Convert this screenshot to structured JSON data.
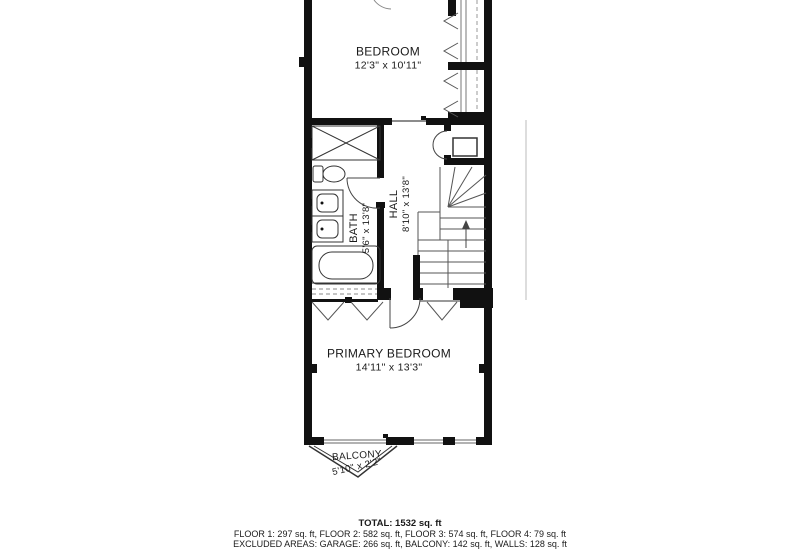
{
  "rooms": {
    "bedroom": {
      "name": "BEDROOM",
      "dims": "12'3\" x 10'11\""
    },
    "bath": {
      "name": "BATH",
      "dims": "5'6\" x 13'8\""
    },
    "hall": {
      "name": "HALL",
      "dims": "8'10\" x 13'8\""
    },
    "primary_bedroom": {
      "name": "PRIMARY BEDROOM",
      "dims": "14'11\" x 13'3\""
    },
    "balcony": {
      "name": "BALCONY",
      "dims": "5'10\" x 2'2\""
    }
  },
  "summary": {
    "total": "TOTAL: 1532 sq. ft",
    "floors": "FLOOR 1: 297 sq. ft, FLOOR 2: 582 sq. ft, FLOOR 3: 574 sq. ft, FLOOR 4: 79 sq. ft",
    "excluded": "EXCLUDED AREAS: GARAGE: 266 sq. ft, BALCONY: 142 sq. ft, WALLS: 128 sq. ft"
  },
  "colors": {
    "background": "#ffffff",
    "wall": "#111111",
    "fixture_line": "#333333",
    "thin_line": "#777777",
    "text": "#1a1a1a"
  }
}
